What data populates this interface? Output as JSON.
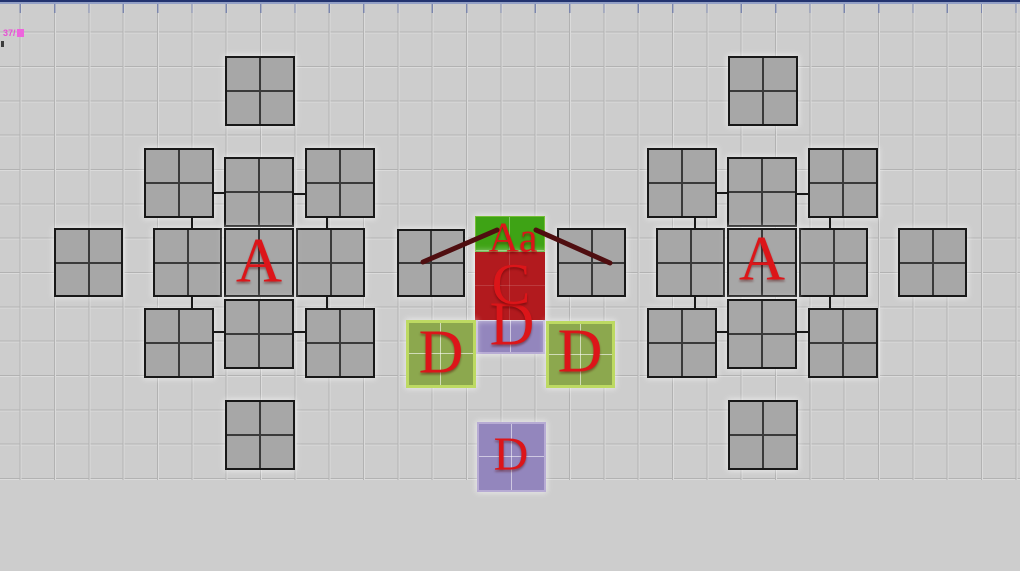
{
  "window": {
    "status_label": "37/",
    "colors": {
      "background": "#cdcdcd",
      "grid_line_dark": "#b2b2b2",
      "grid_line_light": "#dbdbdb",
      "top_bar_dark": "#22336f",
      "top_bar_light": "#93a0c6",
      "square_gray": "#a7a7a7",
      "square_green": "#3ea315",
      "square_red": "#b21a1e",
      "square_purple": "#9386bd",
      "square_lime": "#8ca84e",
      "letter_red": "#dc1519",
      "measure_line": "#4f0e10",
      "status_magenta": "#e94fd4"
    }
  },
  "diagram": {
    "grid": {
      "spacing": 34.33,
      "offset_x": 20.7,
      "offset_y": 32.7,
      "top": 4,
      "bottom": 480
    },
    "squares": [
      {
        "x": 225,
        "y": 56,
        "w": 70,
        "h": 70,
        "kind": "gray"
      },
      {
        "x": 144,
        "y": 148,
        "w": 70,
        "h": 70,
        "kind": "gray"
      },
      {
        "x": 224,
        "y": 157,
        "w": 70,
        "h": 70,
        "kind": "gray"
      },
      {
        "x": 305,
        "y": 148,
        "w": 70,
        "h": 70,
        "kind": "gray"
      },
      {
        "x": 54,
        "y": 228,
        "w": 69,
        "h": 69,
        "kind": "gray"
      },
      {
        "x": 153,
        "y": 228,
        "w": 69,
        "h": 69,
        "kind": "gray"
      },
      {
        "x": 296,
        "y": 228,
        "w": 69,
        "h": 69,
        "kind": "gray"
      },
      {
        "x": 224,
        "y": 228,
        "w": 70,
        "h": 69,
        "kind": "gray",
        "label": "A",
        "label_cx": 259,
        "label_cy": 263,
        "label_size": 64
      },
      {
        "x": 144,
        "y": 308,
        "w": 70,
        "h": 70,
        "kind": "gray"
      },
      {
        "x": 224,
        "y": 299,
        "w": 70,
        "h": 70,
        "kind": "gray"
      },
      {
        "x": 305,
        "y": 308,
        "w": 70,
        "h": 70,
        "kind": "gray"
      },
      {
        "x": 225,
        "y": 400,
        "w": 70,
        "h": 70,
        "kind": "gray"
      },
      {
        "x": 397,
        "y": 229,
        "w": 68,
        "h": 68,
        "kind": "gray"
      },
      {
        "x": 728,
        "y": 56,
        "w": 70,
        "h": 70,
        "kind": "gray"
      },
      {
        "x": 647,
        "y": 148,
        "w": 70,
        "h": 70,
        "kind": "gray"
      },
      {
        "x": 727,
        "y": 157,
        "w": 70,
        "h": 70,
        "kind": "gray"
      },
      {
        "x": 808,
        "y": 148,
        "w": 70,
        "h": 70,
        "kind": "gray"
      },
      {
        "x": 557,
        "y": 228,
        "w": 69,
        "h": 69,
        "kind": "gray"
      },
      {
        "x": 656,
        "y": 228,
        "w": 69,
        "h": 69,
        "kind": "gray"
      },
      {
        "x": 799,
        "y": 228,
        "w": 69,
        "h": 69,
        "kind": "gray"
      },
      {
        "x": 727,
        "y": 228,
        "w": 70,
        "h": 69,
        "kind": "gray",
        "label": "A",
        "label_cx": 762,
        "label_cy": 261,
        "label_size": 64
      },
      {
        "x": 647,
        "y": 308,
        "w": 70,
        "h": 70,
        "kind": "gray"
      },
      {
        "x": 727,
        "y": 299,
        "w": 70,
        "h": 70,
        "kind": "gray"
      },
      {
        "x": 808,
        "y": 308,
        "w": 70,
        "h": 70,
        "kind": "gray"
      },
      {
        "x": 728,
        "y": 400,
        "w": 70,
        "h": 70,
        "kind": "gray"
      },
      {
        "x": 898,
        "y": 228,
        "w": 69,
        "h": 69,
        "kind": "gray"
      },
      {
        "x": 475,
        "y": 216,
        "w": 70,
        "h": 70,
        "kind": "green",
        "label": "Aa",
        "label_cx": 513,
        "label_cy": 240,
        "label_size": 42
      },
      {
        "x": 476,
        "y": 287,
        "w": 69,
        "h": 67,
        "kind": "purple",
        "label": "D",
        "label_cx": 512,
        "label_cy": 327,
        "label_size": 62
      },
      {
        "x": 475,
        "y": 252,
        "w": 70,
        "h": 68,
        "kind": "red",
        "label": "C",
        "label_cx": 511,
        "label_cy": 287,
        "label_size": 58
      },
      {
        "x": 406,
        "y": 320,
        "w": 70,
        "h": 68,
        "kind": "lime",
        "label": "D",
        "label_cx": 441,
        "label_cy": 355,
        "label_size": 62
      },
      {
        "x": 546,
        "y": 321,
        "w": 69,
        "h": 67,
        "kind": "lime",
        "label": "D",
        "label_cx": 580,
        "label_cy": 354,
        "label_size": 62
      },
      {
        "x": 477,
        "y": 422,
        "w": 69,
        "h": 70,
        "kind": "purple",
        "label": "D",
        "label_cx": 511,
        "label_cy": 457,
        "label_size": 48
      }
    ],
    "connectors": [
      {
        "x": 214,
        "y": 192,
        "w": 10,
        "h": 2
      },
      {
        "x": 294,
        "y": 193,
        "w": 11,
        "h": 2
      },
      {
        "x": 191,
        "y": 217,
        "w": 2,
        "h": 12
      },
      {
        "x": 326,
        "y": 217,
        "w": 2,
        "h": 12
      },
      {
        "x": 191,
        "y": 296,
        "w": 2,
        "h": 12
      },
      {
        "x": 326,
        "y": 296,
        "w": 2,
        "h": 12
      },
      {
        "x": 214,
        "y": 331,
        "w": 10,
        "h": 2
      },
      {
        "x": 294,
        "y": 331,
        "w": 11,
        "h": 2
      },
      {
        "x": 717,
        "y": 192,
        "w": 10,
        "h": 2
      },
      {
        "x": 797,
        "y": 193,
        "w": 11,
        "h": 2
      },
      {
        "x": 694,
        "y": 217,
        "w": 2,
        "h": 12
      },
      {
        "x": 829,
        "y": 217,
        "w": 2,
        "h": 12
      },
      {
        "x": 694,
        "y": 296,
        "w": 2,
        "h": 12
      },
      {
        "x": 829,
        "y": 296,
        "w": 2,
        "h": 12
      },
      {
        "x": 717,
        "y": 331,
        "w": 10,
        "h": 2
      },
      {
        "x": 797,
        "y": 331,
        "w": 11,
        "h": 2
      }
    ],
    "measure_lines": [
      {
        "x1": 423,
        "y1": 262,
        "x2": 497,
        "y2": 230
      },
      {
        "x1": 536,
        "y1": 230,
        "x2": 610,
        "y2": 263
      }
    ]
  }
}
